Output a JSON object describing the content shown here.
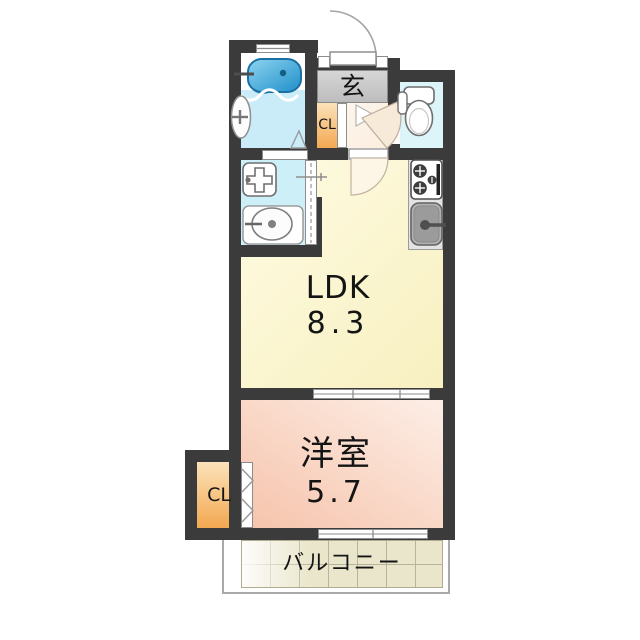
{
  "rooms": {
    "genkan": {
      "label": "玄"
    },
    "closet_upper": {
      "label": "CL"
    },
    "ldk": {
      "name": "LDK",
      "size": "8.3"
    },
    "bedroom": {
      "name": "洋室",
      "size": "5.7"
    },
    "closet_lower": {
      "label": "CL"
    },
    "balcony": {
      "label": "バルコニー"
    }
  },
  "fixtures": {
    "bathtub": "bathtub-icon",
    "bath_window": "window-icon",
    "bath_door": "folding-door-icon",
    "toilet": "toilet-icon",
    "washbasin": "washbasin-icon",
    "washer_pan": "washing-machine-pan-icon",
    "stove": "gas-stove-icon",
    "sink": "kitchen-sink-icon",
    "entrance_door": "entrance-door-swing-icon",
    "sliding_doors": "sliding-door-icon",
    "closet_door": "folding-door-chevron-icon"
  },
  "colors": {
    "wall": "#3b3b3b",
    "bath_floor": "#c9ecf8",
    "tub_light": "#8ed4f0",
    "tub_deep": "#1f8fc9",
    "washroom_floor": "#cdeff8",
    "toilet_floor": "#dcf5f9",
    "genkan_gray": "#cacaca",
    "hallway": "#fbeede",
    "closet_deep": "#f3a851",
    "closet_light": "#fce3ba",
    "ldk_light": "#fefbe3",
    "ldk_deep": "#f8f0c0",
    "bedroom_deep": "#f6c3ab",
    "bedroom_light": "#fdeee6",
    "balcony_beige": "#eae6cb",
    "balcony_grid": "#b8b39a",
    "outline": "#9a9a9a"
  }
}
